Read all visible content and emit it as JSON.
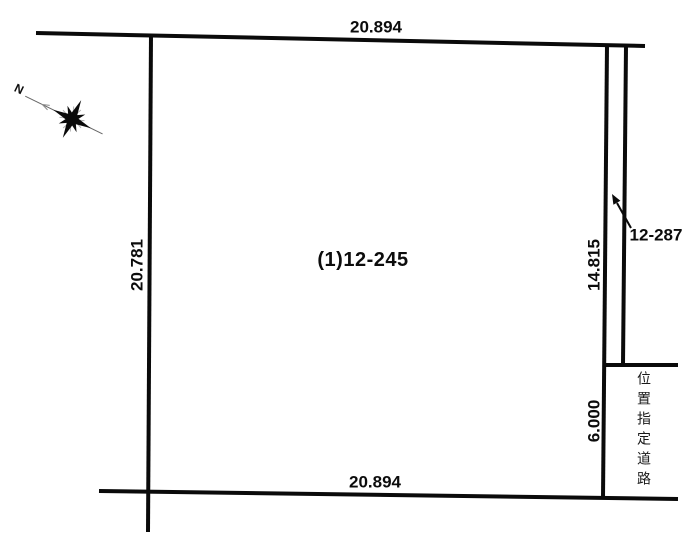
{
  "diagram": {
    "parcel": {
      "label": "(1)12-245"
    },
    "dimensions": {
      "top": "20.894",
      "bottom": "20.894",
      "left": "20.781",
      "right": "14.815",
      "road_width": "6.000"
    },
    "neighbor": {
      "label": "12-287"
    },
    "road": {
      "label": "位置指定道路"
    },
    "compass": {
      "north_label": "N"
    },
    "colors": {
      "line": "#0a0a0a",
      "background": "#ffffff"
    }
  }
}
